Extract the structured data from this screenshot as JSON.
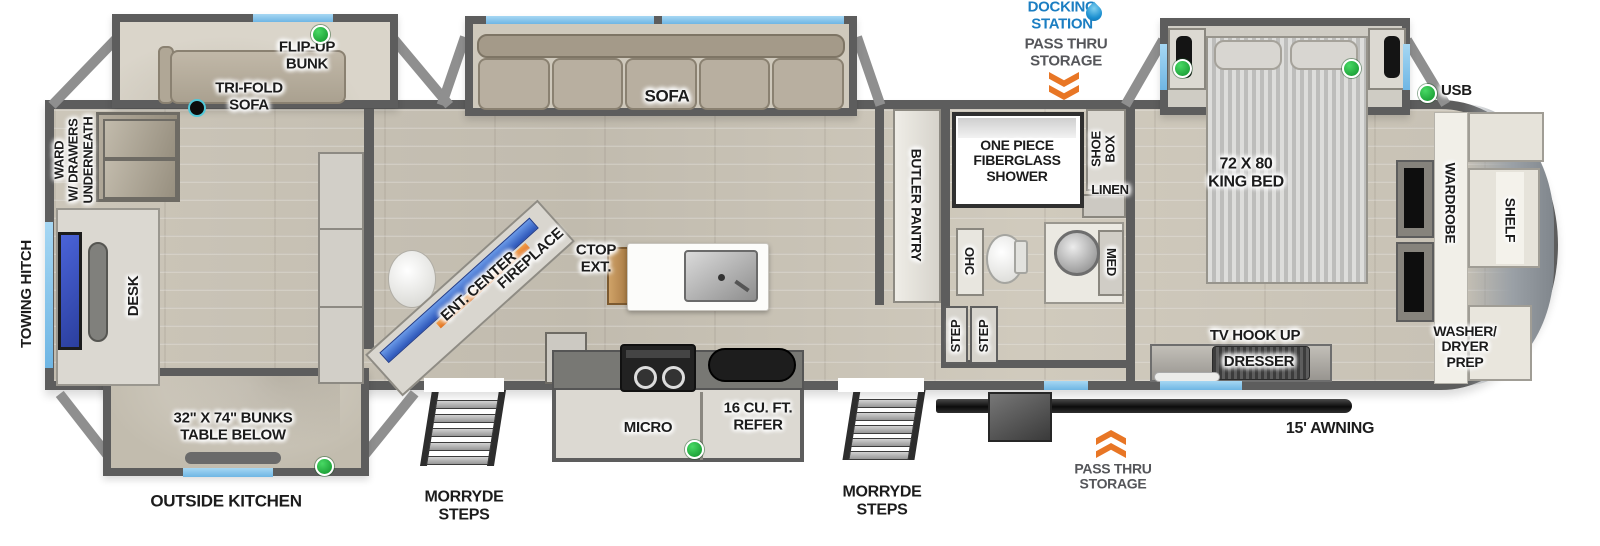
{
  "colors": {
    "label_text": "#1c1c1c",
    "docking_station_blue": "#1b7ec2",
    "chevron_orange": "#e87625",
    "indicator_green": "#25b53e",
    "window_blue": "#7fc0e8",
    "wall_gray": "#5d5d5d",
    "floor_tan": "#c8c2b5"
  },
  "exterior": {
    "towing_hitch": "TOWING HITCH",
    "docking_station": "DOCKING\nSTATION",
    "pass_thru_storage_top": "PASS THRU\nSTORAGE",
    "pass_thru_storage_bottom": "PASS THRU\nSTORAGE",
    "awning": "15' AWNING",
    "morryde_steps_front": "MORRYDE\nSTEPS",
    "morryde_steps_rear": "MORRYDE\nSTEPS",
    "outside_kitchen": "OUTSIDE KITCHEN",
    "usb": "USB"
  },
  "bunk_room": {
    "flip_up_bunk": "FLIP-UP\nBUNK",
    "tri_fold_sofa": "TRI-FOLD\nSOFA",
    "ward": "WARD\nW/ DRAWERS\nUNDERNEATH",
    "desk": "DESK",
    "bunks": "32\" X 74\" BUNKS\nTABLE BELOW"
  },
  "living_area": {
    "sofa": "SOFA",
    "fireplace": "FIREPLACE",
    "ent_center": "ENT. CENTER",
    "ctop_ext": "CTOP\nEXT.",
    "micro": "MICRO",
    "refer": "16 CU. FT.\nREFER",
    "butler_pantry": "BUTLER PANTRY",
    "step_left": "STEP",
    "step_right": "STEP"
  },
  "bathroom": {
    "shower": "ONE PIECE\nFIBERGLASS\nSHOWER",
    "shoe_box": "SHOE\nBOX",
    "linen": "LINEN",
    "ohc": "OHC",
    "med": "MED"
  },
  "bedroom": {
    "king_bed": "72 X 80\nKING BED",
    "tv_hook_up": "TV HOOK UP",
    "dresser": "DRESSER",
    "wardrobe": "WARDROBE",
    "shelf": "SHELF",
    "washer_dryer_prep": "WASHER/\nDRYER\nPREP"
  },
  "icons": {
    "water_drop": "water-drop-icon",
    "chevron_down": "chevron-down-icon",
    "chevron_up": "chevron-up-icon",
    "indicator": "green-indicator-icon",
    "speaker": "speaker-icon"
  }
}
